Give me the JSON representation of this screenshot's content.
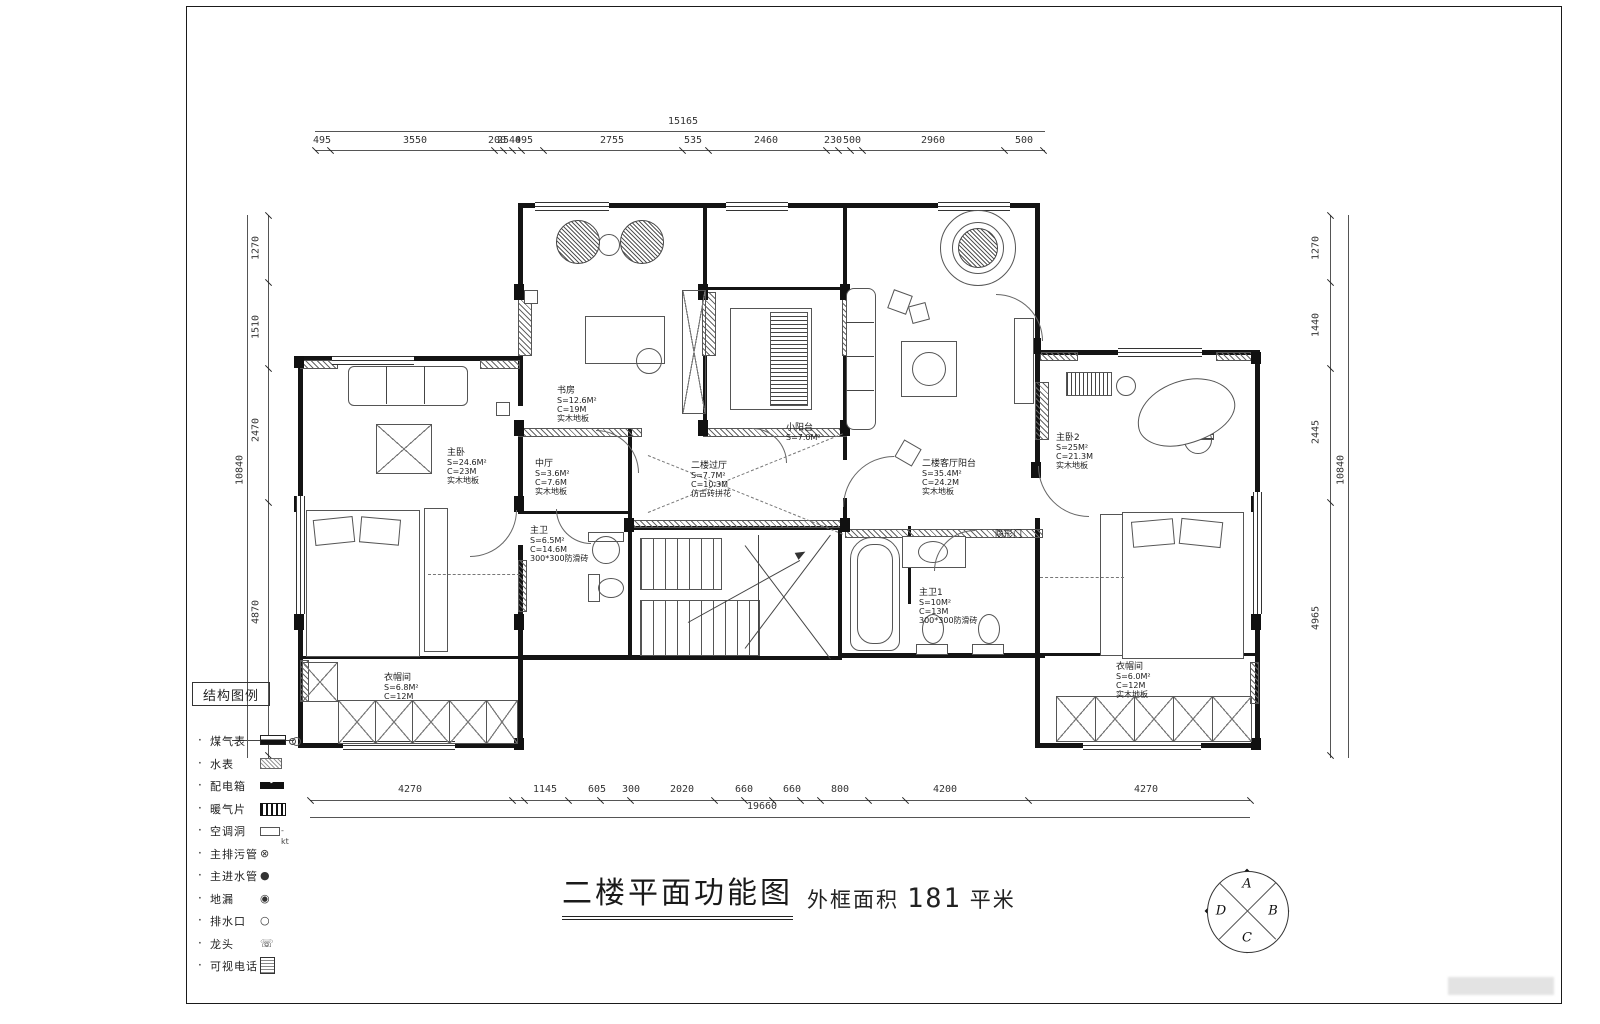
{
  "title": {
    "main": "二楼平面功能图",
    "area_label": "外框面积",
    "area_value": "181",
    "area_unit": "平米"
  },
  "legend": {
    "title": "结构图例",
    "items": [
      {
        "label": "煤气表",
        "symbol": "gas-meter"
      },
      {
        "label": "水表",
        "symbol": "water-meter"
      },
      {
        "label": "配电箱",
        "symbol": "power-box"
      },
      {
        "label": "暖气片",
        "symbol": "radiator"
      },
      {
        "label": "空调洞",
        "symbol": "ac-hole"
      },
      {
        "label": "主排污管",
        "symbol": "sewage-pipe"
      },
      {
        "label": "主进水管",
        "symbol": "water-inlet"
      },
      {
        "label": "地漏",
        "symbol": "floor-drain"
      },
      {
        "label": "排水口",
        "symbol": "drain-outlet"
      },
      {
        "label": "龙头",
        "symbol": "faucet"
      },
      {
        "label": "可视电话",
        "symbol": "video-phone"
      }
    ]
  },
  "dimensions": {
    "top": {
      "total": "15165",
      "segments": [
        "495",
        "3550",
        "200",
        "2540",
        "495",
        "2755",
        "535",
        "2460",
        "230",
        "500",
        "2960",
        "500"
      ]
    },
    "bottom": {
      "total": "19660",
      "segments": [
        "4270",
        "1145",
        "605",
        "300",
        "2020",
        "660",
        "660",
        "800",
        "4200",
        "4270"
      ]
    },
    "left": {
      "total": "10840",
      "segments": [
        "1270",
        "1510",
        "2470",
        "4870"
      ]
    },
    "right": {
      "total": "10840",
      "segments": [
        "1270",
        "1440",
        "2445",
        "4965"
      ]
    }
  },
  "rooms": [
    {
      "name": "主卧",
      "area": "S=24.6M²",
      "perimeter": "C=23M",
      "floor": "实木地板"
    },
    {
      "name": "书房",
      "area": "S=12.6M²",
      "perimeter": "C=19M",
      "floor": "实木地板"
    },
    {
      "name": "中厅",
      "area": "S=3.6M²",
      "perimeter": "C=7.6M",
      "floor": "实木地板"
    },
    {
      "name": "主卫",
      "area": "S=6.5M²",
      "perimeter": "C=14.6M",
      "floor": "300*300防滑砖"
    },
    {
      "name": "二楼过厅",
      "area": "S=7.7M²",
      "perimeter": "C=10.3M",
      "floor": "仿古砖拼花"
    },
    {
      "name": "小阳台",
      "area": "S=7.0M²",
      "perimeter": "",
      "floor": ""
    },
    {
      "name": "二楼客厅阳台",
      "area": "S=35.4M²",
      "perimeter": "C=24.2M",
      "floor": "实木地板"
    },
    {
      "name": "主卧2",
      "area": "S=25M²",
      "perimeter": "C=21.3M",
      "floor": "实木地板"
    },
    {
      "name": "衣帽间",
      "area": "S=6.8M²",
      "perimeter": "C=12M",
      "floor": ""
    },
    {
      "name": "主卫1",
      "area": "S=10M²",
      "perimeter": "C=13M",
      "floor": "300*300防滑砖"
    },
    {
      "name": "衣帽间",
      "area": "S=6.0M²",
      "perimeter": "C=12M",
      "floor": "实木地板"
    },
    {
      "name": "隐形门",
      "area": "",
      "perimeter": "",
      "floor": ""
    }
  ],
  "compass": {
    "letters": [
      "A",
      "B",
      "C",
      "D"
    ]
  }
}
